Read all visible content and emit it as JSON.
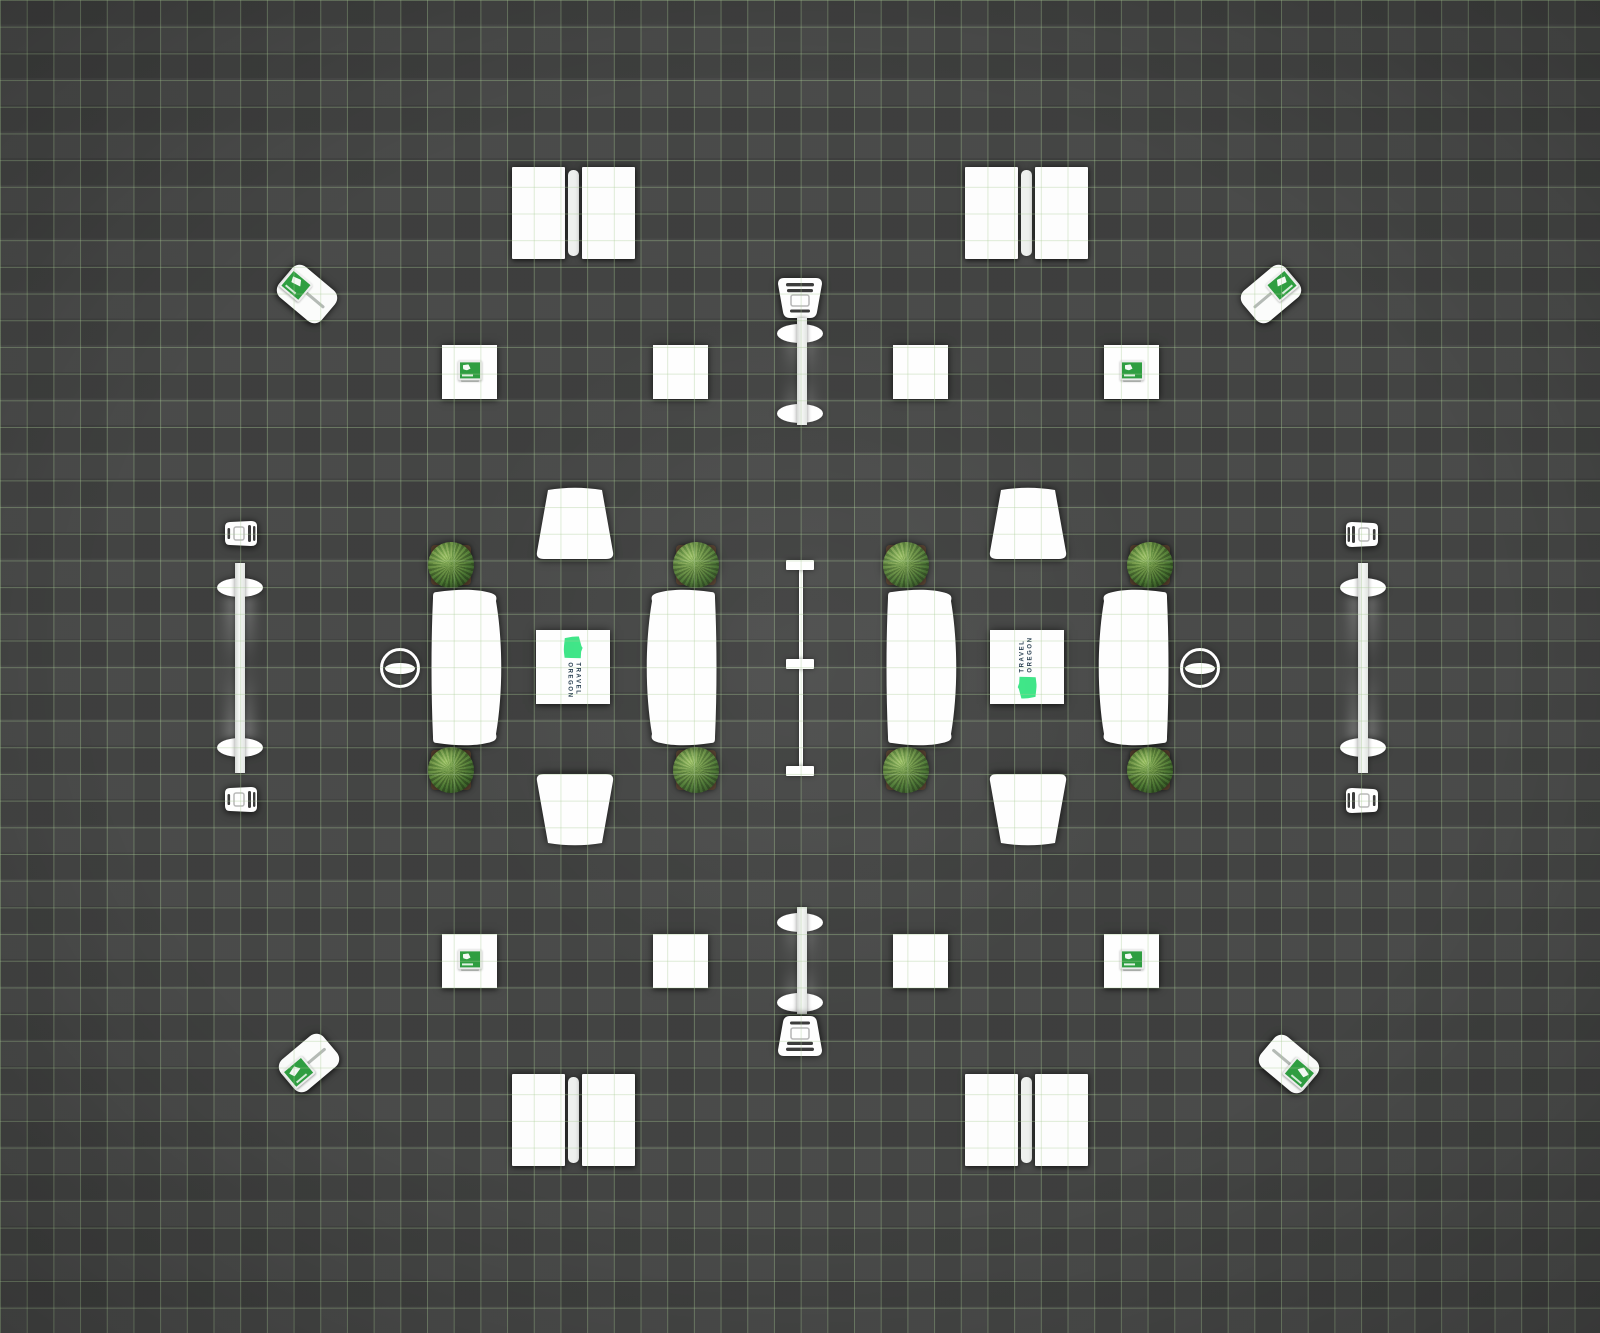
{
  "brand": {
    "logo_line1": "TRAVEL",
    "logo_line2": "OREGON"
  },
  "colors": {
    "floor": "#424342",
    "grid_line_green": "#aacd96",
    "object_white": "#ffffff",
    "brand_green": "#3ce586",
    "logo_text_navy": "#233a4c",
    "sign_green": "#2f9e41",
    "foliage_green": "#4a7030",
    "planter_brown": "#57402e"
  },
  "objects": {
    "display_panel_pairs": 4,
    "sign_tables_with_green_sign": 4,
    "plain_square_tables": 4,
    "kiosk_stands": 4,
    "bar_tables": 4,
    "oval_stools": 8,
    "chairs": 8,
    "seating_groups": 2,
    "curved_tables": 4,
    "trapezoid_benches": 4,
    "potted_bushes": 8,
    "logo_tables": 2,
    "round_leaf_tables": 2,
    "center_divider_posts": 3
  }
}
